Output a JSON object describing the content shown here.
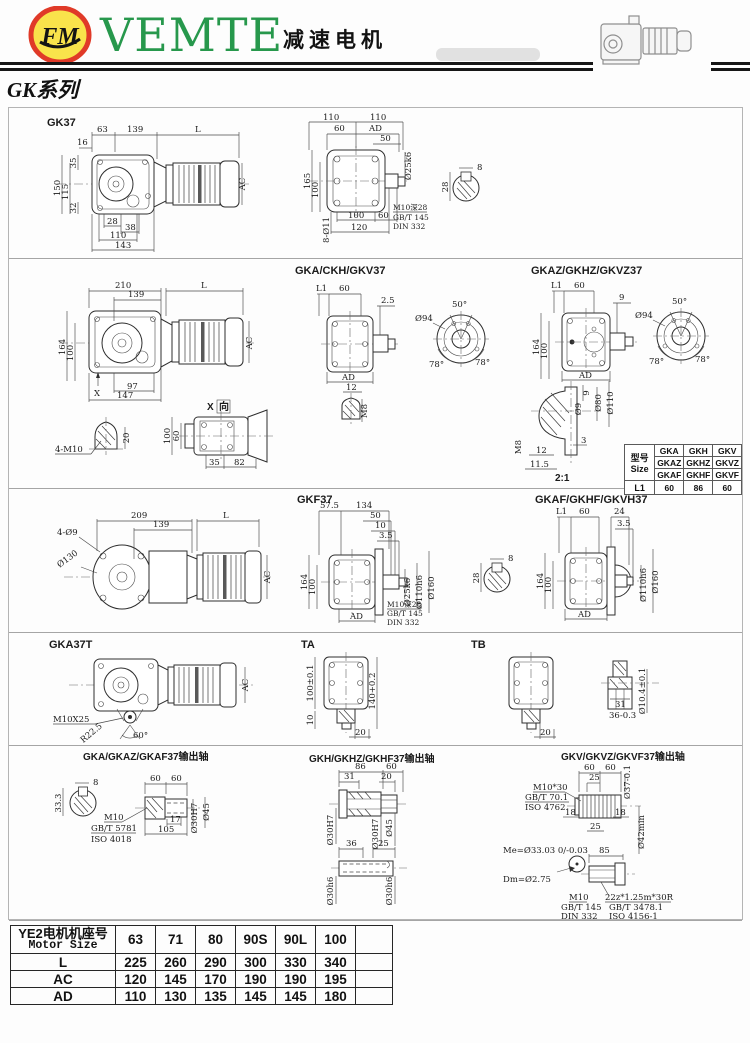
{
  "header": {
    "logo_monogram": "FM",
    "brand": "VEMTE",
    "title_cn": "减速电机",
    "series": "GK系列",
    "brand_color": "#27984c",
    "logo_ring_color": "#e03a28",
    "logo_fill_color": "#f9e34b"
  },
  "gk37": {
    "title": "GK37",
    "side": {
      "top": [
        "63",
        "139",
        "L"
      ],
      "d16": "16",
      "left": [
        "150",
        "115",
        "35",
        "32"
      ],
      "bottom": [
        "28",
        "38",
        "110",
        "143"
      ],
      "ac": "AC"
    },
    "front": {
      "top110": [
        "110",
        "110"
      ],
      "row2": [
        "60",
        "AD"
      ],
      "d50": "50",
      "shaft_dia": "Ø25k6",
      "left": [
        "165",
        "100"
      ],
      "holes": "8-Ø11",
      "bottom": [
        "100",
        "60",
        "120"
      ],
      "notes": [
        "M10深28",
        "GB/T 145",
        "DIN 332"
      ]
    },
    "key": {
      "w": "8",
      "h": "28"
    }
  },
  "gka37": {
    "title": "GKA/CKH/GKV37",
    "side": {
      "top": [
        "210",
        "139",
        "L"
      ],
      "left": [
        "164",
        "100"
      ],
      "bottom": [
        "97",
        "147"
      ],
      "x": "X",
      "ac": "AC"
    },
    "front": {
      "top": [
        "L1",
        "60"
      ],
      "d25": "2.5",
      "ad": "AD"
    },
    "m8": {
      "d12": "12",
      "thread": "M8"
    },
    "ring": {
      "dia": "Ø94",
      "a50": "50°",
      "a78l": "78°",
      "a78r": "78°"
    },
    "dome": {
      "thread": "4-M10",
      "h": "20"
    },
    "xview": {
      "x_label": "X",
      "dir_label": "向",
      "left": [
        "100",
        "60"
      ],
      "bottom": [
        "35",
        "82"
      ]
    }
  },
  "gkaz37": {
    "title": "GKAZ/GKHZ/GKVZ37",
    "front": {
      "top": [
        "L1",
        "60"
      ],
      "d9": "9",
      "left": [
        "164",
        "100"
      ],
      "ad": "AD"
    },
    "ring": {
      "dia": "Ø94",
      "a50": "50°",
      "a78l": "78°",
      "a78r": "78°"
    },
    "detail": {
      "d9": "9",
      "dia9": "Ø9",
      "dia80": "Ø80",
      "dia110": "Ø110",
      "m8": "M8",
      "d12": "12",
      "d115": "11.5",
      "d3": "3",
      "scale": "2:1"
    }
  },
  "size_table": {
    "model_cn": "型号",
    "model_en": "Size",
    "models": [
      [
        "GKA",
        "GKH",
        "GKV"
      ],
      [
        "GKAZ",
        "GKHZ",
        "GKVZ"
      ],
      [
        "GKAF",
        "GKHF",
        "GKVF"
      ]
    ],
    "l1": "L1",
    "l1_values": [
      "60",
      "86",
      "60"
    ]
  },
  "gkf37": {
    "title": "GKF37",
    "side": {
      "top": [
        "209",
        "139",
        "L"
      ],
      "holes": "4-Ø9",
      "dia": "Ø130",
      "ac": "AC"
    },
    "front": {
      "top": [
        "57.5",
        "134"
      ],
      "steps": [
        "50",
        "10",
        "3.5"
      ],
      "dias": [
        "Ø25k6",
        "Ø110h6",
        "Ø160"
      ],
      "left": [
        "164",
        "100"
      ],
      "ad": "AD",
      "notes": [
        "M10深28",
        "GB/T 145",
        "DIN 332"
      ]
    },
    "key": {
      "w": "8",
      "h": "28"
    }
  },
  "gkaf37": {
    "title": "GKAF/GKHF/GKVH37",
    "front": {
      "top": [
        "L1",
        "60",
        "24"
      ],
      "d35": "3.5",
      "left": [
        "164",
        "100"
      ],
      "dias": [
        "Ø110h6",
        "Ø160"
      ],
      "ad": "AD"
    }
  },
  "gka37t": {
    "title": "GKA37T",
    "bolt": "M10X25",
    "radius": "R22.5",
    "angle": "60°",
    "ac": "AC"
  },
  "ta": {
    "title": "TA",
    "h100": "100±0.1",
    "h140": "140+0.2",
    "d10": "10",
    "d20": "20"
  },
  "tb": {
    "title": "TB",
    "d20": "20"
  },
  "bush": {
    "d31": "31",
    "d36": "36-0.3",
    "dia": "Ø10.4±0.1"
  },
  "shaft_a": {
    "title": "GKA/GKAZ/GKAF37输出轴",
    "key_w": "8",
    "key_h": "33.3",
    "top": [
      "60",
      "60"
    ],
    "d17": "17",
    "d105": "105",
    "dia_bore": "Ø30H7",
    "dia_out": "Ø45",
    "notes": [
      "M10",
      "GB/T 5781",
      "ISO 4018"
    ]
  },
  "shaft_h": {
    "title": "GKH/GKHZ/GKHF37输出轴",
    "hollow": {
      "top": [
        "86",
        "60"
      ],
      "row2": [
        "31",
        "20"
      ],
      "dias": [
        "Ø30H7",
        "Ø30H7",
        "Ø45"
      ]
    },
    "solid": {
      "top": [
        "36",
        "25"
      ],
      "dias": [
        "Ø30h6",
        "Ø30h6"
      ]
    }
  },
  "shaft_v": {
    "title": "GKV/GKVZ/GKVF37输出轴",
    "top": [
      "60",
      "60"
    ],
    "d25t": "25",
    "dia37": "Ø37-0.1",
    "d18l": "18",
    "d18r": "18",
    "d25b": "25",
    "dia42": "Ø42min",
    "notes1": [
      "M10*30",
      "GB/T 70.1",
      "ISO 4762"
    ],
    "me": "Me=Ø33.03 0/-0.03",
    "dm": "Dm=Ø2.75",
    "d85": "85",
    "notes2": [
      "M10",
      "GB/T 145",
      "DIN 332"
    ],
    "notes3": [
      "22z*1.25m*30R",
      "GB/T 3478.1",
      "ISO 4156-1"
    ]
  },
  "motor_table": {
    "header_cn": "YE2电机机座号",
    "header_en": "Motor Size",
    "sizes": [
      "63",
      "71",
      "80",
      "90S",
      "90L",
      "100"
    ],
    "rows": [
      {
        "label": "L",
        "values": [
          "225",
          "260",
          "290",
          "300",
          "330",
          "340"
        ]
      },
      {
        "label": "AC",
        "values": [
          "120",
          "145",
          "170",
          "190",
          "190",
          "195"
        ]
      },
      {
        "label": "AD",
        "values": [
          "110",
          "130",
          "135",
          "145",
          "145",
          "180"
        ]
      }
    ]
  }
}
